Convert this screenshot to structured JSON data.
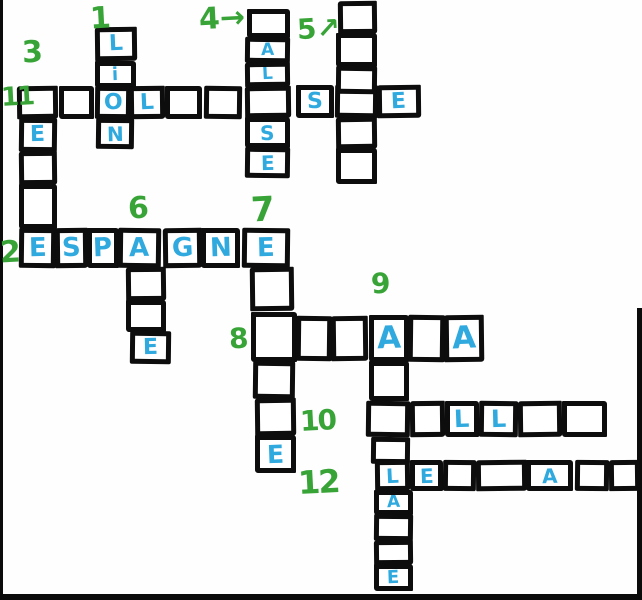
{
  "page": {
    "kind": "hand-drawn crossword puzzle worksheet",
    "background": "#fefefe"
  },
  "colors": {
    "letter_blue": "#2fa9de",
    "number_green": "#38a437",
    "line_black": "#0d0d0d"
  },
  "words_fully_visible": [
    {
      "number": "1",
      "direction": "down",
      "letters": "LiON"
    },
    {
      "number": "2",
      "direction": "across",
      "letters": "ESPAGNE"
    }
  ],
  "grid": {
    "clue_numbers": [
      {
        "label": "1",
        "x": 90,
        "y": 4,
        "size": 30,
        "arrow": null
      },
      {
        "label": "3",
        "x": 22,
        "y": 38,
        "size": 30,
        "arrow": null
      },
      {
        "label": "4",
        "x": 199,
        "y": 4,
        "size": 30,
        "arrow": "right"
      },
      {
        "label": "5",
        "x": 297,
        "y": 15,
        "size": 28,
        "arrow": "up-right"
      },
      {
        "label": "11",
        "x": 1,
        "y": 84,
        "size": 26,
        "arrow": null
      },
      {
        "label": "2",
        "x": 0,
        "y": 238,
        "size": 30,
        "arrow": null
      },
      {
        "label": "6",
        "x": 128,
        "y": 194,
        "size": 30,
        "arrow": null
      },
      {
        "label": "7",
        "x": 251,
        "y": 193,
        "size": 34,
        "arrow": null
      },
      {
        "label": "8",
        "x": 229,
        "y": 325,
        "size": 28,
        "arrow": null
      },
      {
        "label": "9",
        "x": 371,
        "y": 270,
        "size": 28,
        "arrow": null
      },
      {
        "label": "10",
        "x": 300,
        "y": 407,
        "size": 28,
        "arrow": null
      },
      {
        "label": "12",
        "x": 298,
        "y": 466,
        "size": 32,
        "arrow": null
      }
    ],
    "cells": [
      {
        "x": 95,
        "y": 27,
        "w": 42,
        "h": 34,
        "letter": "L"
      },
      {
        "x": 95,
        "y": 61,
        "w": 41,
        "h": 27,
        "letter": "i"
      },
      {
        "x": 96,
        "y": 118,
        "w": 38,
        "h": 31,
        "letter": "N"
      },
      {
        "x": 17,
        "y": 86,
        "w": 41,
        "h": 33,
        "letter": ""
      },
      {
        "x": 59,
        "y": 86,
        "w": 35,
        "h": 33,
        "letter": ""
      },
      {
        "x": 95,
        "y": 86,
        "w": 36,
        "h": 33,
        "letter": "O"
      },
      {
        "x": 129,
        "y": 86,
        "w": 36,
        "h": 33,
        "letter": "L"
      },
      {
        "x": 165,
        "y": 86,
        "w": 37,
        "h": 33,
        "letter": ""
      },
      {
        "x": 204,
        "y": 86,
        "w": 38,
        "h": 33,
        "letter": ""
      },
      {
        "x": 245,
        "y": 86,
        "w": 46,
        "h": 32,
        "letter": ""
      },
      {
        "x": 296,
        "y": 85,
        "w": 38,
        "h": 33,
        "letter": "S"
      },
      {
        "x": 335,
        "y": 85,
        "w": 43,
        "h": 33,
        "letter": ""
      },
      {
        "x": 377,
        "y": 85,
        "w": 44,
        "h": 33,
        "letter": "E"
      },
      {
        "x": 247,
        "y": 9,
        "w": 43,
        "h": 29,
        "letter": ""
      },
      {
        "x": 245,
        "y": 37,
        "w": 45,
        "h": 26,
        "letter": "A"
      },
      {
        "x": 245,
        "y": 62,
        "w": 45,
        "h": 25,
        "letter": "L"
      },
      {
        "x": 245,
        "y": 117,
        "w": 45,
        "h": 31,
        "letter": "S"
      },
      {
        "x": 245,
        "y": 147,
        "w": 45,
        "h": 31,
        "letter": "E"
      },
      {
        "x": 338,
        "y": 1,
        "w": 39,
        "h": 33,
        "letter": ""
      },
      {
        "x": 336,
        "y": 33,
        "w": 41,
        "h": 34,
        "letter": ""
      },
      {
        "x": 336,
        "y": 66,
        "w": 41,
        "h": 28,
        "letter": ""
      },
      {
        "x": 336,
        "y": 117,
        "w": 41,
        "h": 32,
        "letter": ""
      },
      {
        "x": 336,
        "y": 148,
        "w": 41,
        "h": 36,
        "letter": ""
      },
      {
        "x": 19,
        "y": 118,
        "w": 38,
        "h": 34,
        "letter": "E"
      },
      {
        "x": 19,
        "y": 151,
        "w": 38,
        "h": 34,
        "letter": ""
      },
      {
        "x": 19,
        "y": 184,
        "w": 38,
        "h": 45,
        "letter": ""
      },
      {
        "x": 19,
        "y": 228,
        "w": 37,
        "h": 40,
        "letter": "E"
      },
      {
        "x": 55,
        "y": 228,
        "w": 33,
        "h": 40,
        "letter": "S"
      },
      {
        "x": 87,
        "y": 228,
        "w": 32,
        "h": 40,
        "letter": "P"
      },
      {
        "x": 118,
        "y": 228,
        "w": 43,
        "h": 40,
        "letter": "A"
      },
      {
        "x": 163,
        "y": 228,
        "w": 39,
        "h": 40,
        "letter": "G"
      },
      {
        "x": 201,
        "y": 228,
        "w": 39,
        "h": 40,
        "letter": "N"
      },
      {
        "x": 242,
        "y": 228,
        "w": 48,
        "h": 40,
        "letter": "E"
      },
      {
        "x": 126,
        "y": 267,
        "w": 40,
        "h": 34,
        "letter": ""
      },
      {
        "x": 126,
        "y": 300,
        "w": 40,
        "h": 32,
        "letter": ""
      },
      {
        "x": 130,
        "y": 331,
        "w": 41,
        "h": 33,
        "letter": "E"
      },
      {
        "x": 250,
        "y": 267,
        "w": 44,
        "h": 44,
        "letter": ""
      },
      {
        "x": 251,
        "y": 312,
        "w": 46,
        "h": 50,
        "letter": ""
      },
      {
        "x": 253,
        "y": 361,
        "w": 42,
        "h": 38,
        "letter": ""
      },
      {
        "x": 255,
        "y": 398,
        "w": 41,
        "h": 38,
        "letter": ""
      },
      {
        "x": 255,
        "y": 435,
        "w": 41,
        "h": 38,
        "letter": "E"
      },
      {
        "x": 296,
        "y": 316,
        "w": 36,
        "h": 45,
        "letter": ""
      },
      {
        "x": 331,
        "y": 316,
        "w": 37,
        "h": 45,
        "letter": ""
      },
      {
        "x": 369,
        "y": 315,
        "w": 40,
        "h": 47,
        "letter": "A"
      },
      {
        "x": 408,
        "y": 315,
        "w": 37,
        "h": 47,
        "letter": ""
      },
      {
        "x": 444,
        "y": 315,
        "w": 40,
        "h": 47,
        "letter": "A"
      },
      {
        "x": 369,
        "y": 361,
        "w": 40,
        "h": 40,
        "letter": ""
      },
      {
        "x": 366,
        "y": 401,
        "w": 44,
        "h": 36,
        "letter": ""
      },
      {
        "x": 410,
        "y": 401,
        "w": 35,
        "h": 36,
        "letter": ""
      },
      {
        "x": 445,
        "y": 401,
        "w": 34,
        "h": 36,
        "letter": "L"
      },
      {
        "x": 479,
        "y": 401,
        "w": 39,
        "h": 36,
        "letter": "L"
      },
      {
        "x": 518,
        "y": 401,
        "w": 44,
        "h": 36,
        "letter": ""
      },
      {
        "x": 562,
        "y": 401,
        "w": 45,
        "h": 36,
        "letter": ""
      },
      {
        "x": 371,
        "y": 437,
        "w": 39,
        "h": 27,
        "letter": ""
      },
      {
        "x": 375,
        "y": 460,
        "w": 35,
        "h": 31,
        "letter": "L"
      },
      {
        "x": 410,
        "y": 460,
        "w": 33,
        "h": 31,
        "letter": "E"
      },
      {
        "x": 443,
        "y": 460,
        "w": 33,
        "h": 31,
        "letter": ""
      },
      {
        "x": 476,
        "y": 460,
        "w": 51,
        "h": 31,
        "letter": ""
      },
      {
        "x": 526,
        "y": 460,
        "w": 47,
        "h": 31,
        "letter": "A"
      },
      {
        "x": 575,
        "y": 460,
        "w": 34,
        "h": 31,
        "letter": ""
      },
      {
        "x": 609,
        "y": 460,
        "w": 31,
        "h": 31,
        "letter": ""
      },
      {
        "x": 374,
        "y": 490,
        "w": 39,
        "h": 25,
        "letter": "A"
      },
      {
        "x": 374,
        "y": 514,
        "w": 39,
        "h": 27,
        "letter": ""
      },
      {
        "x": 374,
        "y": 540,
        "w": 39,
        "h": 25,
        "letter": ""
      },
      {
        "x": 374,
        "y": 564,
        "w": 39,
        "h": 27,
        "letter": "E"
      }
    ]
  }
}
